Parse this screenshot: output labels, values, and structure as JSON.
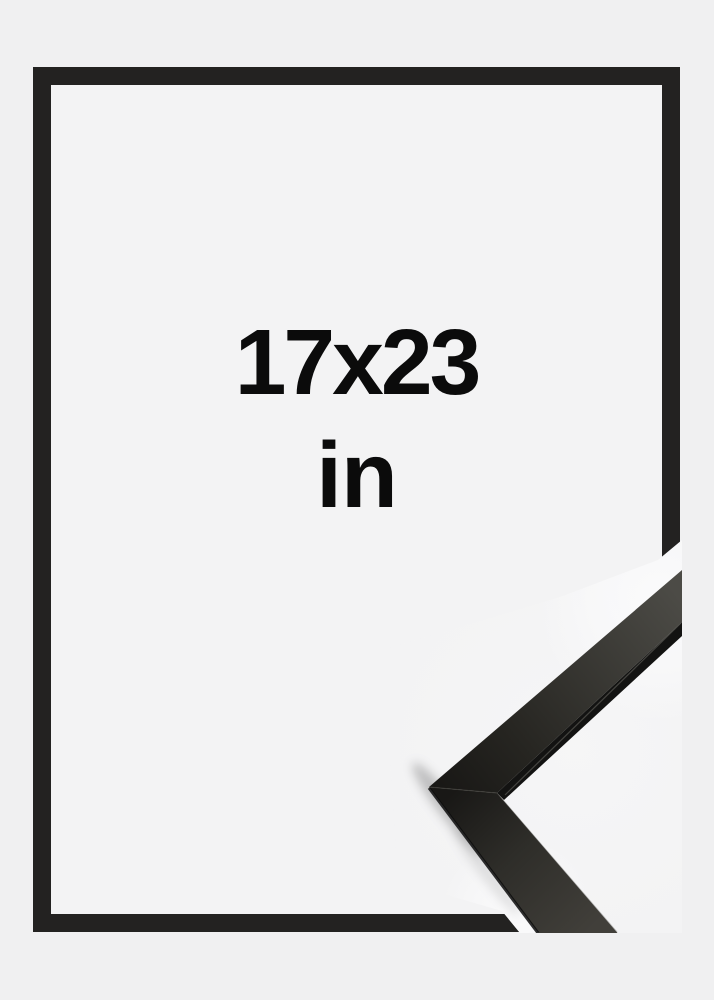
{
  "product": {
    "size_label": "17x23",
    "unit_label": "in"
  },
  "colors": {
    "page_background": "#f0f0f1",
    "frame_opening_background": "#f3f3f4",
    "frame_border": "#232221",
    "label_text": "#0b0b0b",
    "moulding_dark": "#131312",
    "moulding_surface_gray": "#4c4b46",
    "photo_highlight": "#fbfbfc"
  }
}
